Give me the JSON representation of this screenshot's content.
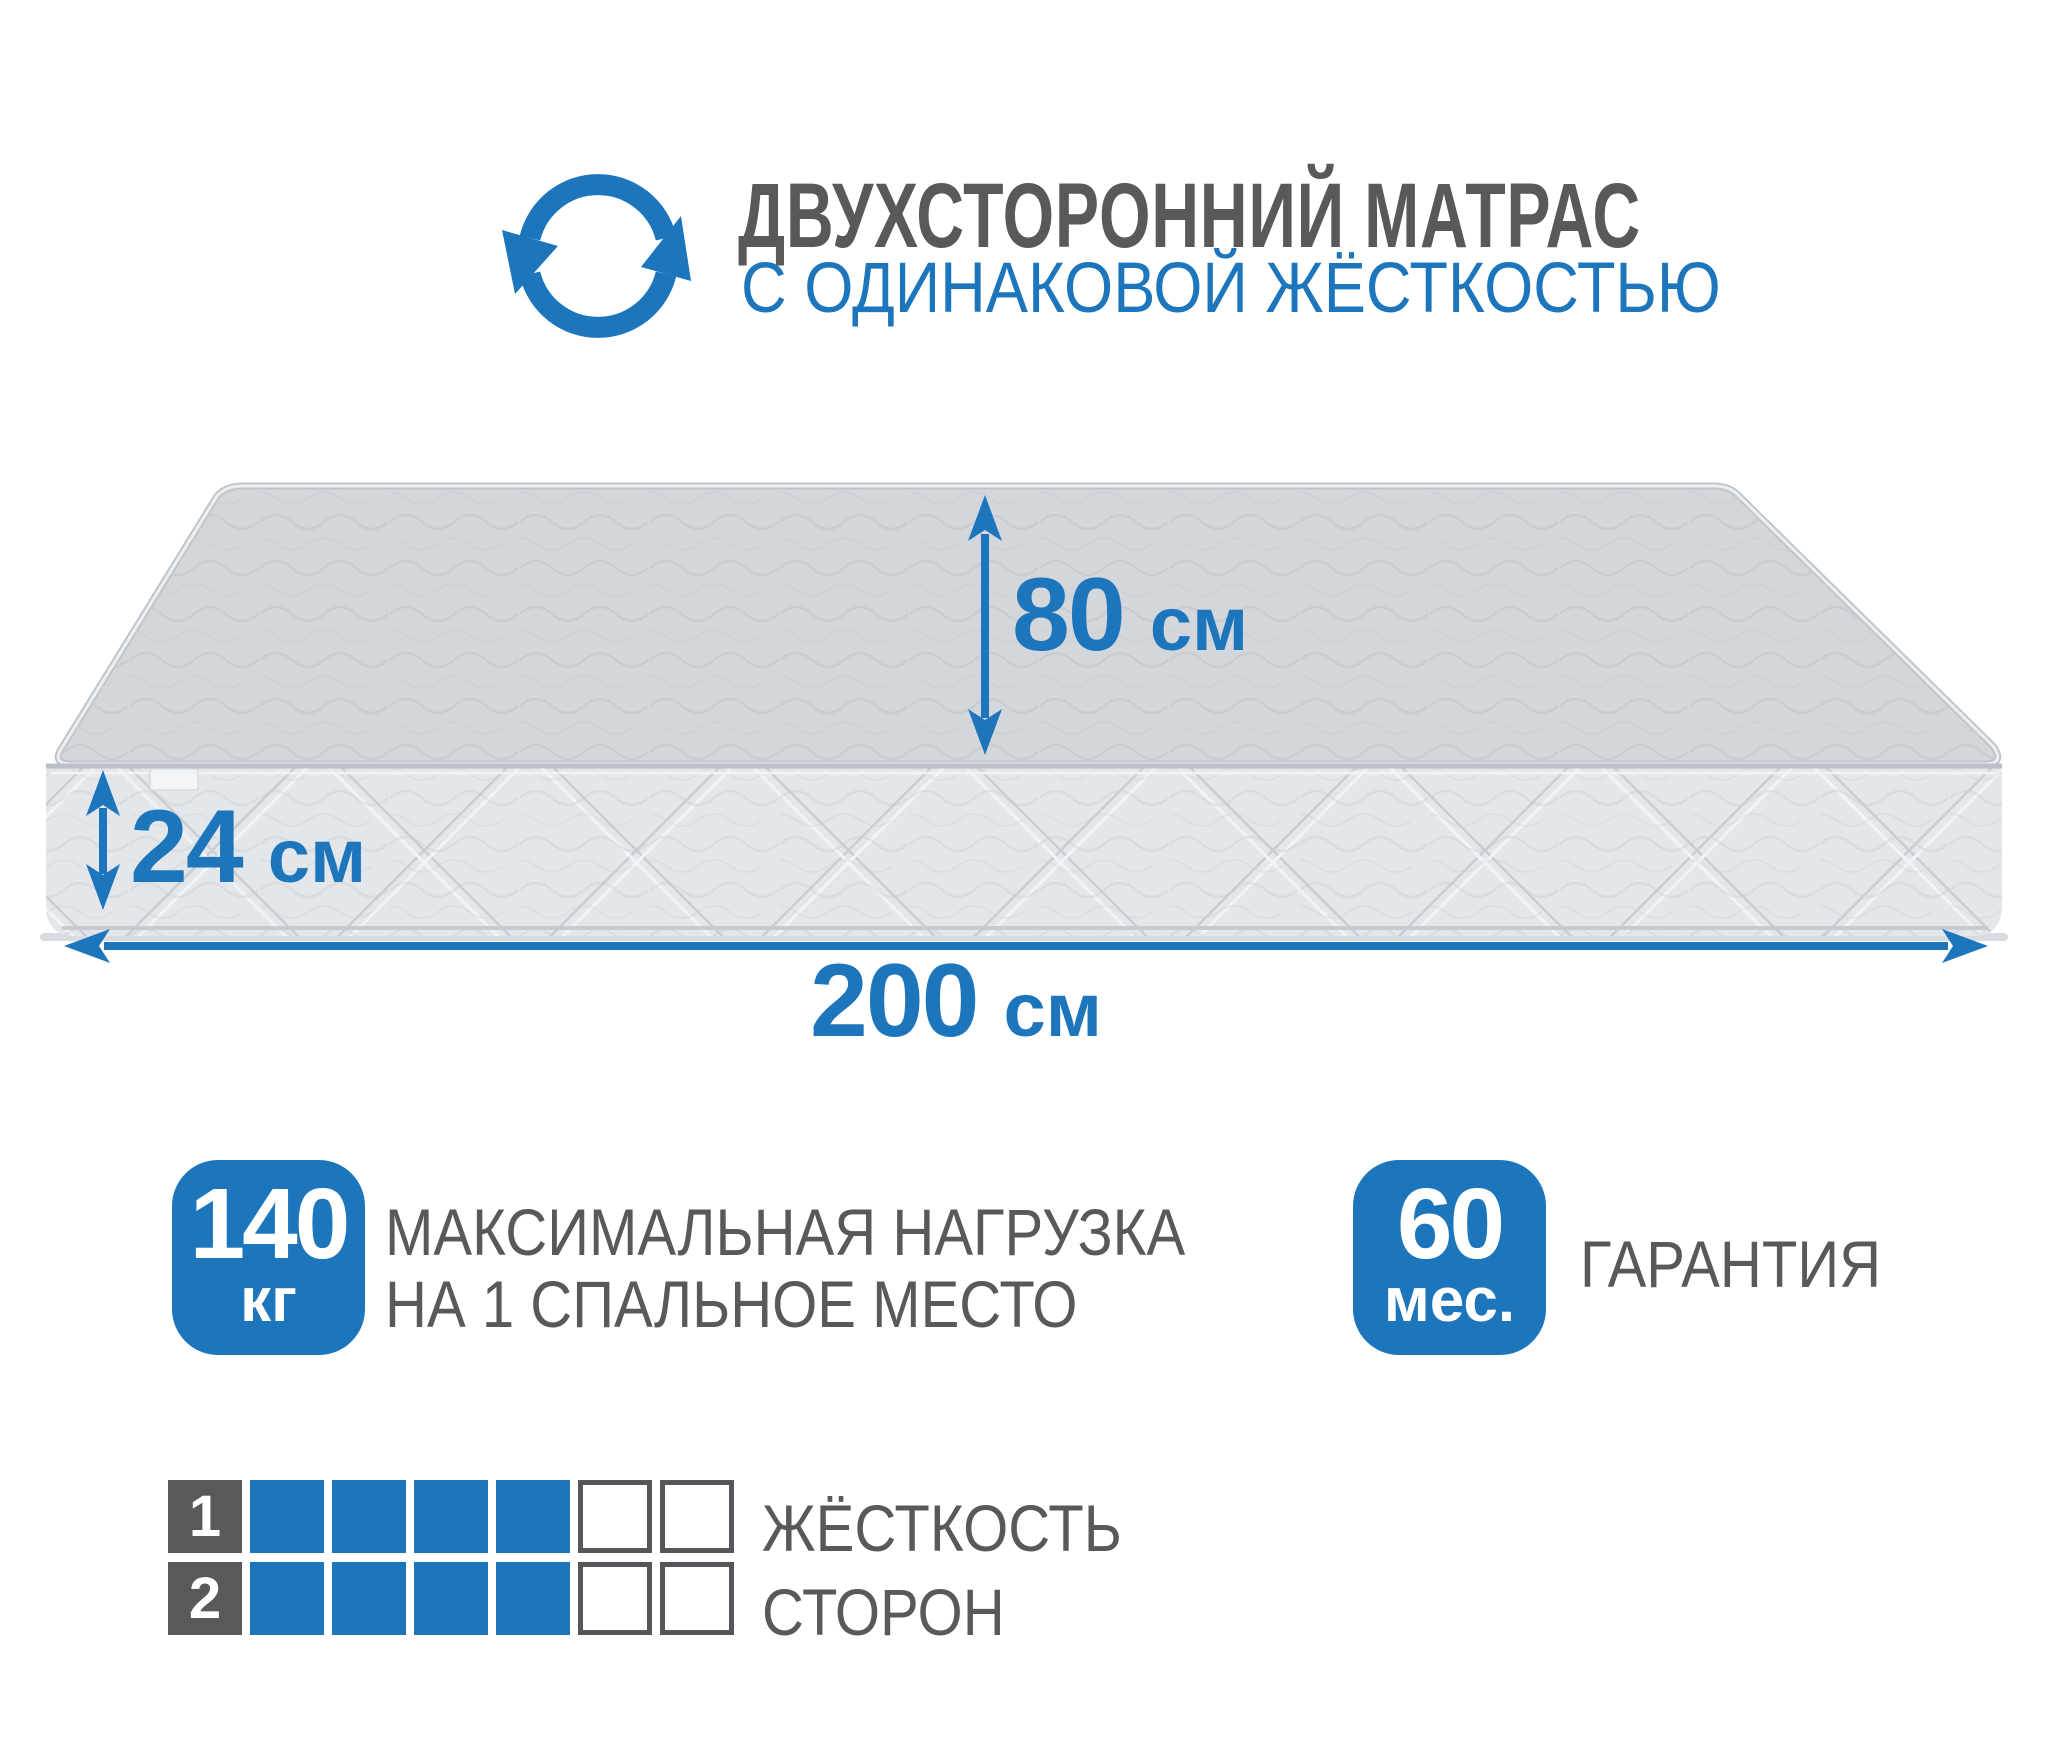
{
  "header": {
    "icon": "rotate-flip-icon",
    "title": "ДВУХСТОРОННИЙ МАТРАС",
    "subtitle": "С ОДИНАКОВОЙ ЖЁСТКОСТЬЮ"
  },
  "mattress": {
    "dimensions": {
      "width": {
        "value": "80",
        "unit": "см"
      },
      "height": {
        "value": "24",
        "unit": "см"
      },
      "length": {
        "value": "200",
        "unit": "см"
      }
    }
  },
  "features": {
    "max_load": {
      "value": "140",
      "unit": "кг",
      "label_line1": "МАКСИМАЛЬНАЯ НАГРУЗКА",
      "label_line2": "НА 1 СПАЛЬНОЕ МЕСТО"
    },
    "warranty": {
      "value": "60",
      "unit": "мес.",
      "label": "ГАРАНТИЯ"
    }
  },
  "hardness_scale": {
    "label_line1": "ЖЁСТКОСТЬ",
    "label_line2": "СТОРОН",
    "cells_total": 6,
    "rows": [
      {
        "side": "1",
        "filled": 4
      },
      {
        "side": "2",
        "filled": 4
      }
    ]
  },
  "colors": {
    "accent_blue": "#1d76bc",
    "text_gray": "#58595b",
    "mattress_top": "#d3d7dc",
    "mattress_front": "#e3e6ea"
  }
}
